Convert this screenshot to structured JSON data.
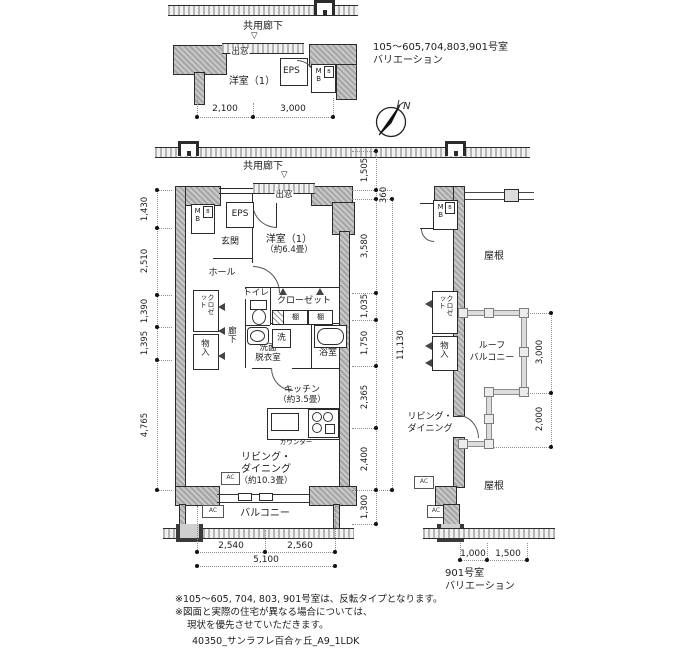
{
  "annotations": {
    "variation_note_line1": "105〜605,704,803,901号室",
    "variation_note_line2": "バリエーション",
    "compass_n": "N"
  },
  "top_plan": {
    "corridor": "共用廊下",
    "bay_window": "出窓",
    "bay_marker": "▽",
    "western_room": "洋室（1）",
    "eps": "EPS",
    "mb": "MB",
    "mb_sub": "B",
    "dims_bottom": [
      "2,100",
      "3,000"
    ]
  },
  "main_plan": {
    "corridor": "共用廊下",
    "bay_window": "出窓",
    "bay_marker": "▽",
    "mb": "MB",
    "mb_sub": "B",
    "eps": "EPS",
    "entrance": "玄関",
    "hall": "ホール",
    "western_room": "洋室（1）",
    "western_room_size": "（約6.4畳）",
    "toilet": "トイレ",
    "closet_hall": "クロゼット",
    "storage": "物入",
    "corridor_inner": "廊下",
    "closet": "クローゼット",
    "shelf_left": "棚",
    "shelf_right": "棚",
    "washer": "洗",
    "washroom_line1": "洗面",
    "washroom_line2": "脱衣室",
    "bathroom": "浴室",
    "kitchen": "キッチン",
    "kitchen_size": "（約3.5畳）",
    "counter": "カウンター",
    "living_line1": "リビング・",
    "living_line2": "ダイニング",
    "living_size": "（約10.3畳）",
    "ac_living": "AC",
    "ac_balcony": "AC",
    "balcony": "バルコニー",
    "dims_left": [
      "1,430",
      "2,510",
      "1,390",
      "1,395",
      "4,765"
    ],
    "dims_right": [
      "1,505",
      "360",
      "3,580",
      "1,035",
      "1,750",
      "2,365",
      "2,400",
      "1,300"
    ],
    "dim_total_right": "11,130",
    "dims_bottom": [
      "2,540",
      "2,560"
    ],
    "dim_total_bottom": "5,100"
  },
  "right_plan": {
    "mb": "MB",
    "mb_sub": "B",
    "roof_upper": "屋根",
    "closet_hall": "クロゼット",
    "storage": "物入",
    "roof_balcony_line1": "ルーフ",
    "roof_balcony_line2": "バルコニー",
    "living_line1": "リビング・",
    "living_line2": "ダイニング",
    "roof_lower": "屋根",
    "ac_upper": "AC",
    "ac_lower": "AC",
    "dims_right": [
      "3,000",
      "2,000"
    ],
    "dims_bottom": [
      "1,000",
      "1,500"
    ],
    "caption_line1": "901号室",
    "caption_line2": "バリエーション"
  },
  "footnotes": {
    "line1": "※105〜605, 704, 803, 901号室は、反転タイプとなります。",
    "line2": "※図面と実際の住宅が異なる場合については、",
    "line3": "現状を優先させていただきます。",
    "line4": "40350_サンラフレ百合ヶ丘_A9_1LDK"
  },
  "colors": {
    "wall_fill": "#b3b3b3",
    "line": "#2b2b2b",
    "dim": "#8a8a8a"
  }
}
